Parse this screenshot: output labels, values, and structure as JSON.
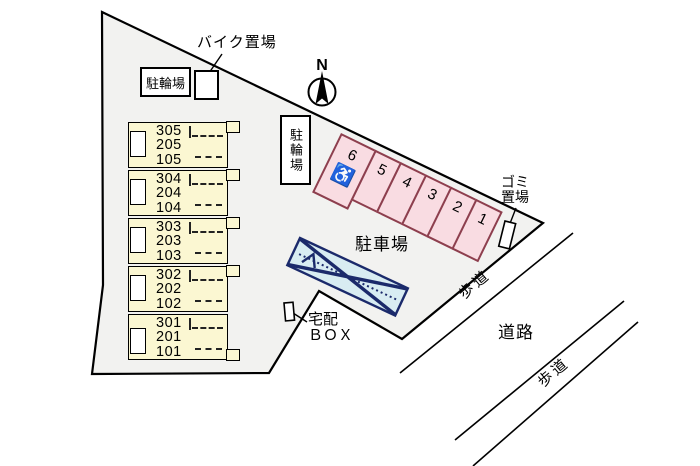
{
  "meta": {
    "type": "property-site-plan"
  },
  "colors": {
    "site_fill": "#f2f2f0",
    "building_fill": "#fbf7d2",
    "parking_fill": "#f9dce2",
    "parking_border": "#8d3f4e",
    "ramp_fill": "#d8ecf2",
    "ramp_border": "#1b2a6b",
    "line": "#000000"
  },
  "north": {
    "label": "N"
  },
  "labels": {
    "bike_storage": "バイク置場",
    "bicycle_parking_top": "駐輪場",
    "bicycle_parking_mid": "駐輪場",
    "parking_lot": "駐車場",
    "garbage_line1": "ゴミ",
    "garbage_line2": "置場",
    "delivery_line1": "宅配",
    "delivery_line2": "ＢＯＸ",
    "road": "道路",
    "sidewalk_upper": "歩道",
    "sidewalk_lower": "歩道"
  },
  "building": {
    "groups": [
      {
        "units": [
          "305",
          "205",
          "105"
        ]
      },
      {
        "units": [
          "304",
          "204",
          "104"
        ]
      },
      {
        "units": [
          "303",
          "203",
          "103"
        ]
      },
      {
        "units": [
          "302",
          "202",
          "102"
        ]
      },
      {
        "units": [
          "301",
          "201",
          "101"
        ]
      }
    ]
  },
  "parking": {
    "spaces": [
      "6",
      "5",
      "4",
      "3",
      "2",
      "1"
    ],
    "accessible_icon": "♿"
  }
}
